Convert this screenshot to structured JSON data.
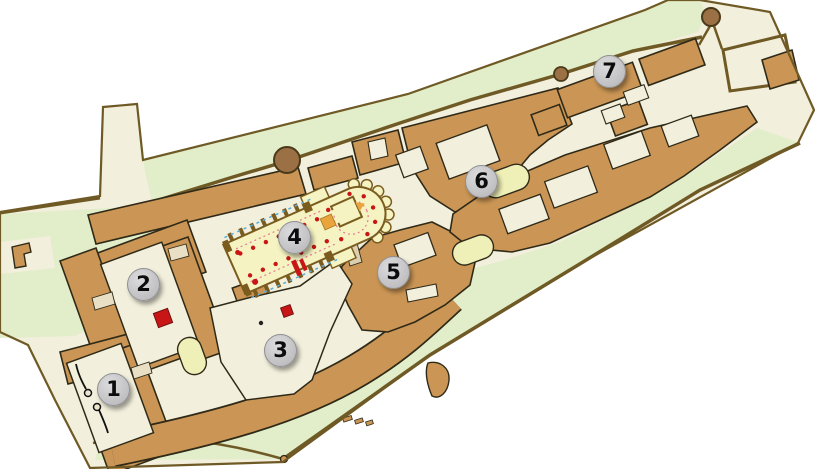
{
  "map": {
    "markers": [
      {
        "label": "1",
        "x": 113,
        "y": 389
      },
      {
        "label": "2",
        "x": 143,
        "y": 284
      },
      {
        "label": "3",
        "x": 280,
        "y": 350
      },
      {
        "label": "4",
        "x": 294,
        "y": 237
      },
      {
        "label": "5",
        "x": 393,
        "y": 272
      },
      {
        "label": "6",
        "x": 481,
        "y": 181
      },
      {
        "label": "7",
        "x": 609,
        "y": 71
      }
    ],
    "palette": {
      "ground": "#f2efdc",
      "lawn": "#e2eec9",
      "building": "#cb9655",
      "building_outline": "#2f2a18",
      "wall": "#6f5a26",
      "church_fill": "#f5f3c2",
      "church_detail": "#7b5c1f",
      "chapel_fill": "#eff0b8",
      "passage": "#e8dfc4",
      "accent_red": "#c81616",
      "accent_orange": "#e9a43c",
      "accent_pink": "#e87898",
      "accent_blue": "#57aede",
      "tree": "#9b7045",
      "marker_background": "#c9c9cb",
      "marker_text": "#0c0c0c"
    }
  }
}
